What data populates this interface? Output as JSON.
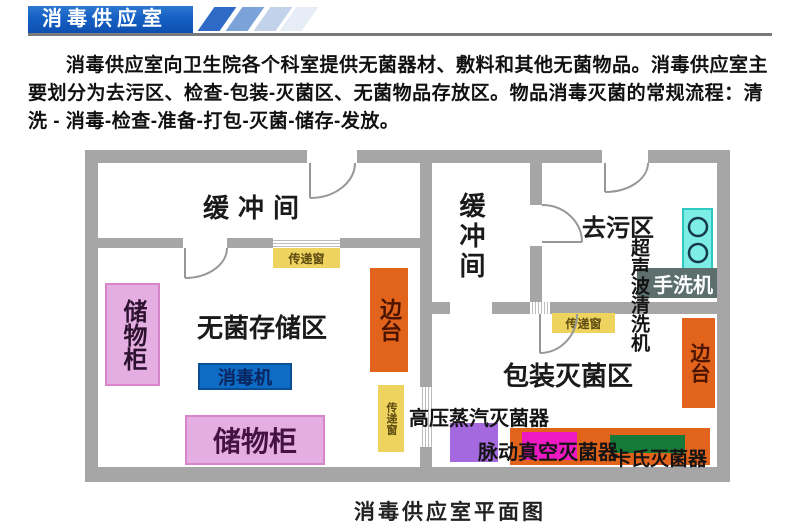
{
  "header": {
    "title": "消毒供应室"
  },
  "intro": {
    "text": "消毒供应室向卫生院各个科室提供无菌器材、敷料和其他无菌物品。消毒供应室主要划分为去污区、检查-包装-灭菌区、无菌物品存放区。物品消毒灭菌的常规流程：清洗 - 消毒-检查-准备-打包-灭菌-储存-发放。"
  },
  "floorplan": {
    "caption": "消毒供应室平面图",
    "rooms": {
      "buffer_left": "缓冲间",
      "buffer_right": "缓冲间",
      "decontamination": "去污区",
      "sterile_storage": "无菌存储区",
      "packaging_sterilization": "包装灭菌区"
    },
    "equipment": {
      "cabinet_left": "储物柜",
      "cabinet_bottom": "储物柜",
      "disinfector": "消毒机",
      "side_table_left": "边台",
      "side_table_right": "边台",
      "pass_window_1": "传递窗",
      "pass_window_2": "传递窗",
      "pass_window_3": "传递窗",
      "ultrasonic_cleaner": "超声波清洗机",
      "hand_washer": "手洗机",
      "steam_sterilizer": "高压蒸汽灭菌器",
      "vacuum_sterilizer": "脉动真空灭菌器",
      "cassette_sterilizer": "卡氏灭菌器"
    },
    "colors": {
      "wall": "#a6a6a6",
      "banner_blue": "#1560c4",
      "yellow": "#efd35f",
      "orange": "#e2631b",
      "pink": "#e5aee2",
      "equipment_blue": "#0f6cc4",
      "cyan": "#7deee6",
      "slate": "#5c6f6d",
      "purple": "#a569df",
      "magenta": "#ed1ac4",
      "green": "#157a38"
    }
  }
}
